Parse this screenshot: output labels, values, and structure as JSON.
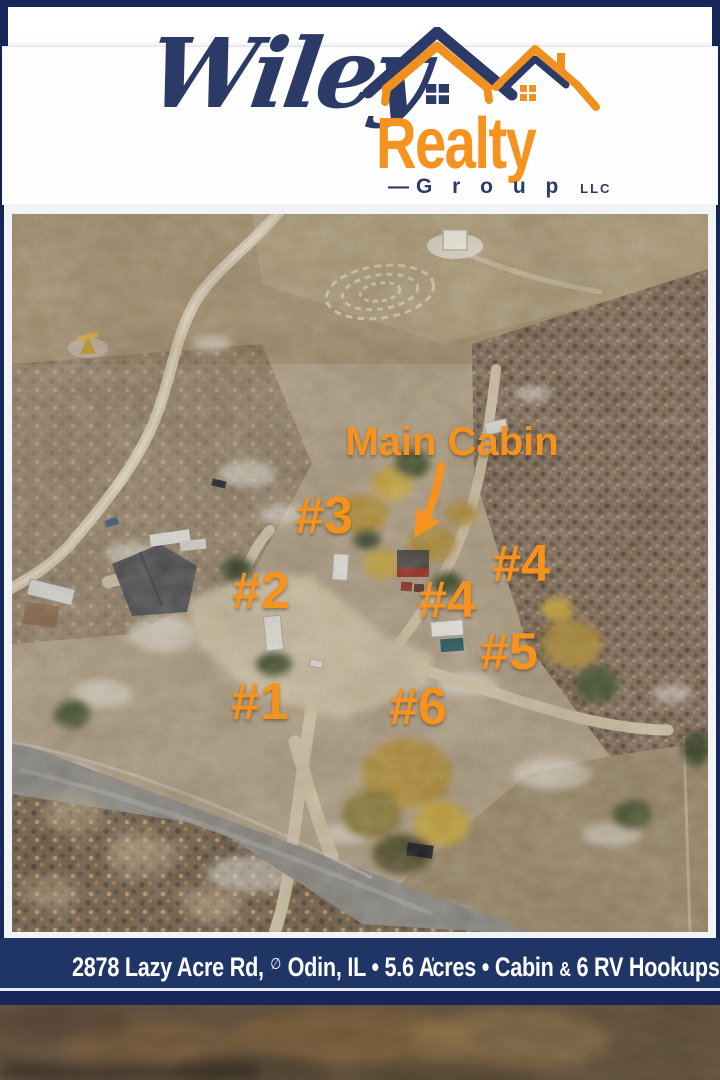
{
  "brand": {
    "script_name": "Wiley",
    "main_name": "Realty",
    "dash": "—",
    "sub_name": "G r o u p",
    "suffix": "LLC"
  },
  "colors": {
    "frame_navy": "#18275a",
    "bar_navy": "#1e3566",
    "brand_navy": "#2c3a68",
    "accent_orange": "#f6921e",
    "text_white": "#ffffff"
  },
  "photo_overlay": {
    "main_cabin": "Main Cabin",
    "markers": {
      "m1": "#1",
      "m2": "#2",
      "m3": "#3",
      "m4_upper": "#4",
      "m4_lower": "#4",
      "m5": "#5",
      "m6": "#6"
    }
  },
  "footer": {
    "address": "2878 Lazy Acre Rd,",
    "marker_glyph": "∅",
    "city_state": "Odin, IL",
    "bullet": "•",
    "acres_lead": "5.6 A",
    "acres_tick": "ʹ",
    "acres_tail": "cres",
    "cabin": "Cabin",
    "ampersand": "&",
    "hookups": "6 RV Hookups"
  }
}
